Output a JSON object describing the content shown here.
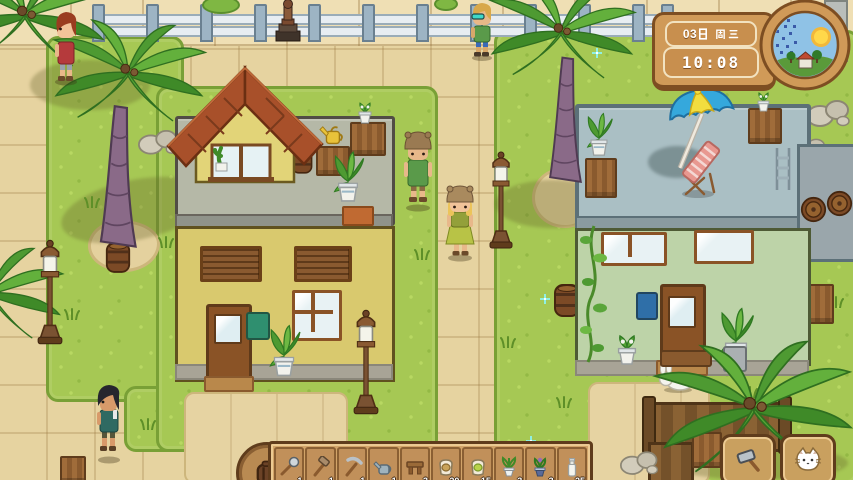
{
  "hud": {
    "date": "03日 周三",
    "date_day": "03",
    "time": "10:08",
    "weather_condition": "sunny",
    "colors": {
      "panel": "#d09a58",
      "panel_border": "#7d4e22",
      "box_border": "#f2e2c0",
      "text": "#ffffff"
    }
  },
  "hotbar": {
    "slots": [
      {
        "item": "shovel",
        "count": "1"
      },
      {
        "item": "hammer",
        "count": "1"
      },
      {
        "item": "pickaxe",
        "count": "1"
      },
      {
        "item": "watering-can",
        "count": "1"
      },
      {
        "item": "wooden-stool",
        "count": "3"
      },
      {
        "item": "seed-bag-brown",
        "count": "20"
      },
      {
        "item": "seed-bag-green",
        "count": "15"
      },
      {
        "item": "potted-plant",
        "count": "3"
      },
      {
        "item": "potted-flower",
        "count": "3"
      },
      {
        "item": "milk-bottle",
        "count": "25"
      }
    ]
  },
  "action_buttons": {
    "build": "mallet",
    "pet": "cat"
  },
  "scene": {
    "npcs": [
      "red-shirt-boy",
      "sunglasses-kid",
      "green-vest-man",
      "green-dress-woman",
      "dark-hair-boy"
    ],
    "animals": [
      "white-rabbit"
    ],
    "buildings": [
      "yellow-house-roof-terrace",
      "green-house-pool-deck"
    ],
    "props": [
      "palm-trees",
      "street-lamps",
      "barrels",
      "beach-umbrella",
      "lounge-chair",
      "statue",
      "white-fence",
      "wooden-fence"
    ]
  }
}
